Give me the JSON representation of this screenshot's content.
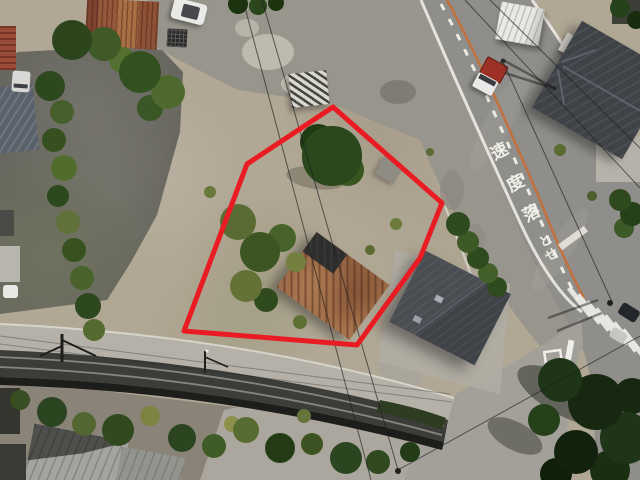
{
  "image": {
    "kind": "aerial-drone-photograph",
    "scene": "vacant land parcel outlined in red, beside a two-lane road with painted speed warning, a railway line below, sheds, houses and parked vehicles around"
  },
  "boundary": {
    "color": "#ea1c23",
    "stroke_width": 5,
    "points": "333,107 442,203 420,258 357,345 184,331 247,164"
  },
  "road_markings": {
    "chars": [
      "速",
      "度",
      "落",
      "と",
      "せ"
    ],
    "color": "#f2f1ea"
  },
  "palette": {
    "lot_ground": "#b1a795",
    "gray_pavement": "#98958d",
    "road_asphalt": "#8f8e8a",
    "road_center_line": "#c4703c",
    "road_edge_line": "#e9e7e0",
    "parking_asphalt": "#67665e",
    "railway_gravel": "#b5b1a8",
    "railway_track": "#3c3c39",
    "rusty_roof": "#9c6845",
    "dark_house_roof": "#3f4348",
    "tree_dark": "#2b471c",
    "tree_light": "#5a6c33"
  },
  "objects": {
    "property_boundary": "red outlined parcel",
    "rusty_shed": "rusted corrugated roof shed inside boundary",
    "large_tree": "round green tree inside boundary",
    "parking_lot": "dark asphalt lot at top left",
    "rusty_warehouse": "long rusted-roof building at top",
    "white_minivan": "white vehicle parked top center",
    "kei_truck": "white truck with red load on road",
    "white_warehouse": "white shed right of road",
    "dark_hip_roof_house": "large dark roof house top right",
    "modern_dark_house": "dark metal roof house lower right",
    "crosswalk": "zebra crossing at intersection",
    "stop_marking": "white box and bar on side road",
    "railway": "railway line across lower left",
    "garden_trees": "trees and hedges along bottom",
    "house_roofs": "gray house roofs bottom left"
  }
}
